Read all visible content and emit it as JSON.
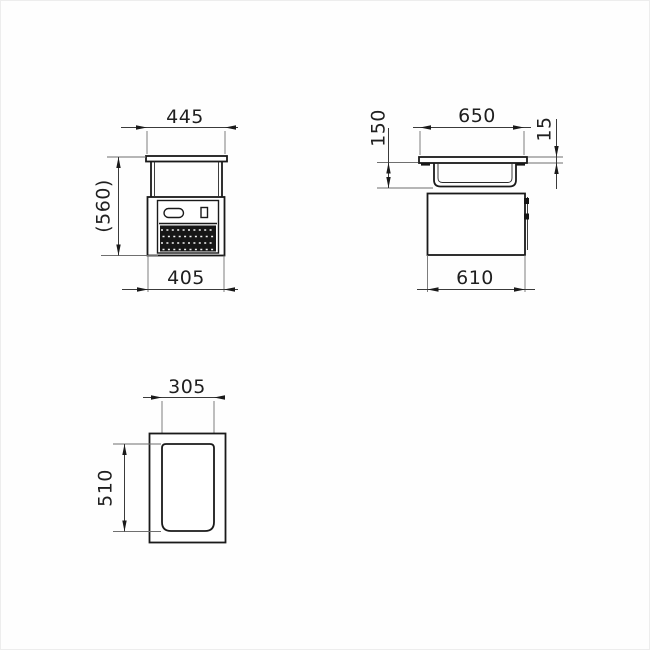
{
  "drawing": {
    "type": "technical-orthographic-views",
    "views": {
      "front": {
        "label": "front-view",
        "dim_top": "445",
        "dim_left": "(560)",
        "dim_bottom": "405"
      },
      "side": {
        "label": "side-view",
        "dim_top": "650",
        "dim_left": "150",
        "dim_right": "15",
        "dim_bottom": "610"
      },
      "plan": {
        "label": "plan-view",
        "dim_top": "305",
        "dim_left": "510"
      }
    },
    "colors": {
      "line": "#1a1a1a",
      "dim_line": "#3a3a3a",
      "extension_line": "#6f6f6f",
      "text": "#1f1f1f",
      "grille_fill": "#161616",
      "background": "#fefefe"
    }
  }
}
